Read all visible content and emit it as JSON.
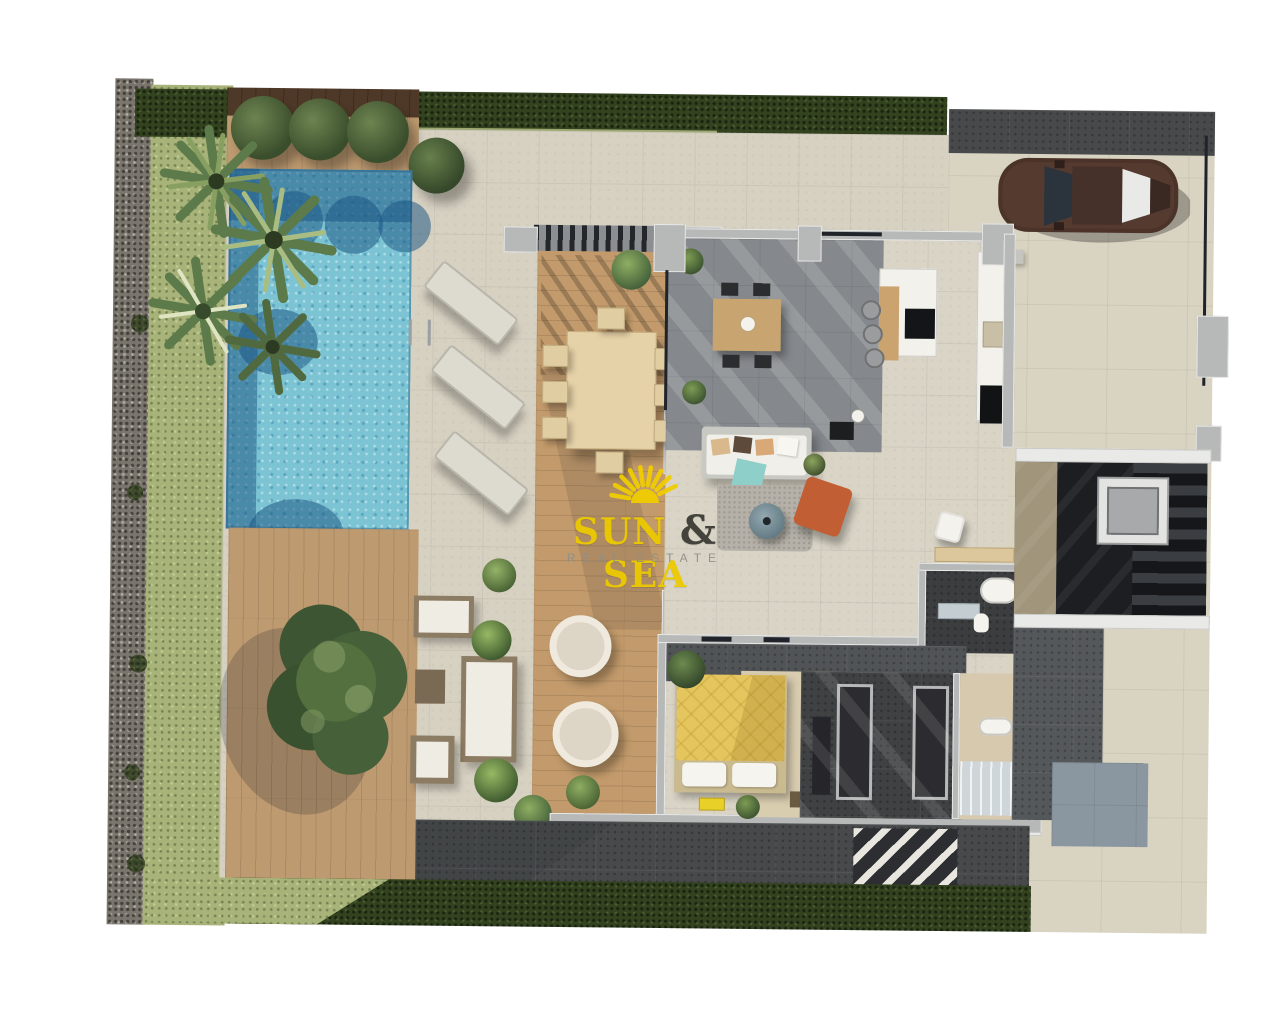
{
  "watermark": {
    "word1": "SUN",
    "ampersand": "&",
    "word2": "SEA",
    "tagline": "REAL ESTATE"
  },
  "palette": {
    "brand_yellow": "#f0cd00",
    "ampersand_gray": "#3c3c35",
    "tagline_gray": "#8f8f88",
    "pool_water": "#7cc4d4",
    "pool_shadow": "#2f6f9e",
    "bed_duvet_yellow": "#e5c55e",
    "accent_chair_orange": "#c25e33",
    "teal_throw": "#8ecfc9",
    "wood_deck": "#c29a6b",
    "stone_patio": "#d7d1c2",
    "charcoal_tile": "#47494b",
    "grass_green": "#a8b37a",
    "hedge_green": "#33421f",
    "car_body_brown": "#4b332a",
    "wall_gray": "#b7b9b9"
  }
}
